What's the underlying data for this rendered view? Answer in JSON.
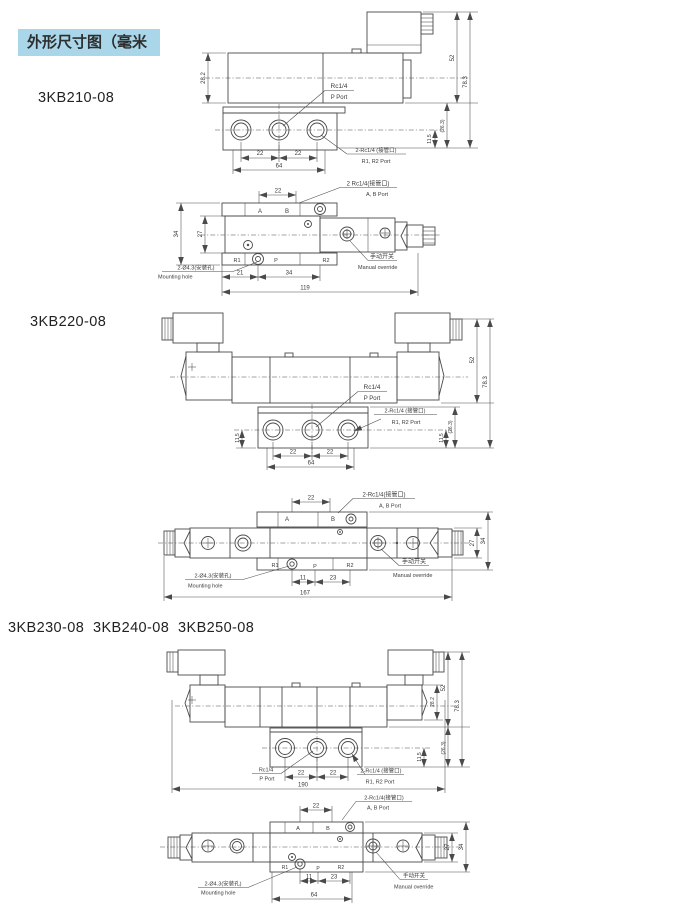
{
  "header": {
    "title": "外形尺寸图（毫米",
    "bg": "#a9d6e8"
  },
  "models": {
    "m1": "3KB210-08",
    "m2": "3KB220-08",
    "m3": "3KB230-08  3KB240-08  3KB250-08"
  },
  "labels": {
    "rc14": "Rc1/4",
    "p_port": "P Port",
    "rc14_r1r2": "2-Rc1/4 (接管口)",
    "r1r2_port": "R1, R2 Port",
    "rc14_ab_sp": "2 Rc1/4(接管口)",
    "rc14_ab": "2-Rc1/4(接管口)",
    "ab_port": "A, B Port",
    "mount_cn": "2-Ø4.3(安装孔)",
    "mount_en": "Mounting hole",
    "manual_cn": "手动开关",
    "manual_en": "Manual override",
    "a": "A",
    "b": "B",
    "r1": "R1",
    "p": "P",
    "r2": "R2"
  },
  "d1f": {
    "h_body": "28.2",
    "h_coil": "52",
    "h_total": "78.3",
    "h_base": "(26.3)",
    "h_port": "11.5",
    "p1": "22",
    "p2": "22",
    "base": "64"
  },
  "d1t": {
    "ab": "22",
    "inner": "27",
    "outer": "34",
    "b1": "21",
    "b2": "34",
    "total": "119"
  },
  "d2f": {
    "h_coil": "52",
    "h_total": "78.3",
    "h_base": "(26.3)",
    "h_port_l": "11.5",
    "h_port_r": "11.5",
    "p1": "22",
    "p2": "22",
    "base": "64"
  },
  "d2t": {
    "ab": "22",
    "b1": "11",
    "b2": "23",
    "total": "167",
    "inner": "27",
    "outer": "34"
  },
  "d3f": {
    "h_body": "28.2",
    "h_coil": "52",
    "h_total": "78.3",
    "h_base": "(26.3)",
    "h_port": "11.5",
    "p1": "22",
    "p2": "22",
    "total": "190"
  },
  "d3t": {
    "ab": "22",
    "b1": "11",
    "b2": "23",
    "base": "64",
    "inner": "27",
    "outer": "34"
  }
}
